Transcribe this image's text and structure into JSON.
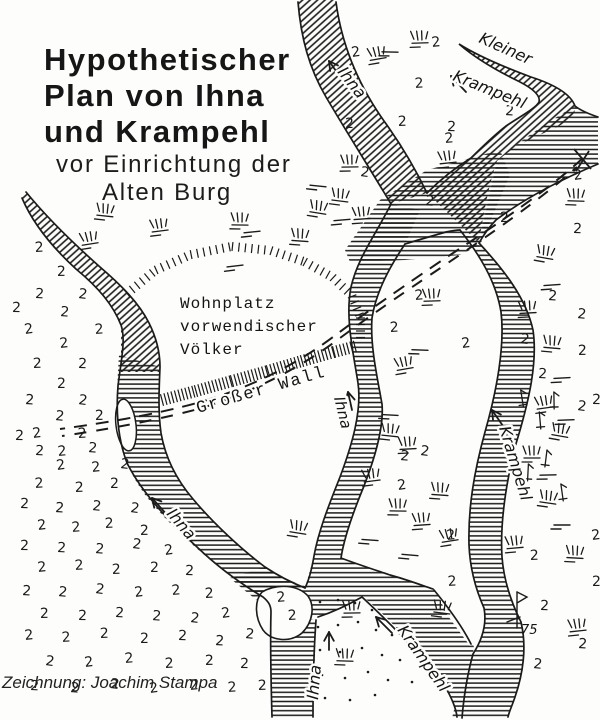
{
  "title": {
    "line1": "Hypothetischer",
    "line2": "Plan von Ihna",
    "line3": "und Krampehl",
    "line4": "vor Einrichtung der",
    "line5": "Alten Burg"
  },
  "credit": "Zeichnung: Joachim Stampa",
  "signature": {
    "year": "75"
  },
  "labels": {
    "ihna_top": "Ihna",
    "kleiner": "Kleiner",
    "krampehl_top": "Krampehl",
    "ihna_mid": "Ihna",
    "krampehl_right": "Krampehl",
    "ihna_sw": "Ihna",
    "ihna_bottom": "Ihna",
    "krampehl_bottom": "Krampehl",
    "wall": "Großer Wall",
    "wohnplatz": [
      "Wohnplatz",
      "vorwendischer",
      "Völker"
    ]
  },
  "colors": {
    "ink": "#1b1b1b",
    "paper": "#fdfdfb"
  },
  "map_symbols": {
    "marsh_glyph": "2",
    "marsh_positions": [
      [
        352,
        57
      ],
      [
        432,
        47
      ],
      [
        415,
        88
      ],
      [
        398,
        126
      ],
      [
        345,
        128
      ],
      [
        447,
        131
      ],
      [
        505,
        115
      ],
      [
        425,
        205
      ],
      [
        360,
        176
      ],
      [
        574,
        180
      ],
      [
        445,
        143
      ],
      [
        35,
        252
      ],
      [
        57,
        276
      ],
      [
        12,
        312
      ],
      [
        35,
        298
      ],
      [
        60,
        316
      ],
      [
        78,
        298
      ],
      [
        25,
        334
      ],
      [
        60,
        348
      ],
      [
        95,
        334
      ],
      [
        33,
        368
      ],
      [
        57,
        388
      ],
      [
        78,
        368
      ],
      [
        25,
        404
      ],
      [
        55,
        420
      ],
      [
        78,
        404
      ],
      [
        33,
        438
      ],
      [
        58,
        456
      ],
      [
        78,
        438
      ],
      [
        95,
        420
      ],
      [
        15,
        440
      ],
      [
        35,
        455
      ],
      [
        88,
        452
      ],
      [
        120,
        468
      ],
      [
        57,
        470
      ],
      [
        92,
        472
      ],
      [
        35,
        488
      ],
      [
        75,
        492
      ],
      [
        110,
        488
      ],
      [
        20,
        508
      ],
      [
        55,
        512
      ],
      [
        92,
        510
      ],
      [
        130,
        512
      ],
      [
        38,
        530
      ],
      [
        72,
        532
      ],
      [
        105,
        528
      ],
      [
        140,
        535
      ],
      [
        20,
        550
      ],
      [
        57,
        552
      ],
      [
        95,
        553
      ],
      [
        132,
        548
      ],
      [
        165,
        555
      ],
      [
        38,
        572
      ],
      [
        75,
        570
      ],
      [
        112,
        574
      ],
      [
        150,
        572
      ],
      [
        185,
        575
      ],
      [
        22,
        595
      ],
      [
        58,
        596
      ],
      [
        95,
        593
      ],
      [
        135,
        597
      ],
      [
        172,
        595
      ],
      [
        205,
        598
      ],
      [
        40,
        618
      ],
      [
        78,
        620
      ],
      [
        115,
        617
      ],
      [
        152,
        620
      ],
      [
        190,
        622
      ],
      [
        222,
        618
      ],
      [
        25,
        640
      ],
      [
        62,
        642
      ],
      [
        100,
        638
      ],
      [
        140,
        643
      ],
      [
        178,
        640
      ],
      [
        215,
        645
      ],
      [
        245,
        638
      ],
      [
        45,
        665
      ],
      [
        85,
        667
      ],
      [
        125,
        663
      ],
      [
        165,
        668
      ],
      [
        205,
        665
      ],
      [
        240,
        668
      ],
      [
        30,
        690
      ],
      [
        70,
        692
      ],
      [
        110,
        688
      ],
      [
        150,
        693
      ],
      [
        190,
        690
      ],
      [
        228,
        692
      ],
      [
        258,
        690
      ],
      [
        500,
        222
      ],
      [
        573,
        233
      ],
      [
        548,
        300
      ],
      [
        577,
        318
      ],
      [
        520,
        343
      ],
      [
        462,
        348
      ],
      [
        415,
        300
      ],
      [
        390,
        332
      ],
      [
        578,
        355
      ],
      [
        592,
        404
      ],
      [
        538,
        378
      ],
      [
        400,
        460
      ],
      [
        420,
        455
      ],
      [
        398,
        490
      ],
      [
        447,
        540
      ],
      [
        448,
        586
      ],
      [
        530,
        560
      ],
      [
        592,
        586
      ],
      [
        540,
        610
      ],
      [
        578,
        648
      ],
      [
        533,
        668
      ],
      [
        577,
        410
      ],
      [
        592,
        540
      ],
      [
        277,
        602
      ],
      [
        288,
        620
      ]
    ],
    "tuft_positions": [
      [
        378,
        58
      ],
      [
        420,
        42
      ],
      [
        105,
        215
      ],
      [
        160,
        230
      ],
      [
        240,
        224
      ],
      [
        318,
        212
      ],
      [
        362,
        218
      ],
      [
        300,
        240
      ],
      [
        90,
        243
      ],
      [
        350,
        166
      ],
      [
        340,
        200
      ],
      [
        448,
        162
      ],
      [
        576,
        200
      ],
      [
        545,
        257
      ],
      [
        528,
        312
      ],
      [
        552,
        347
      ],
      [
        545,
        407
      ],
      [
        532,
        457
      ],
      [
        548,
        502
      ],
      [
        515,
        547
      ],
      [
        575,
        557
      ],
      [
        405,
        368
      ],
      [
        432,
        300
      ],
      [
        390,
        435
      ],
      [
        372,
        480
      ],
      [
        398,
        510
      ],
      [
        298,
        532
      ],
      [
        422,
        524
      ],
      [
        440,
        494
      ],
      [
        450,
        540
      ],
      [
        352,
        612
      ],
      [
        442,
        612
      ],
      [
        578,
        630
      ],
      [
        345,
        660
      ],
      [
        560,
        435
      ],
      [
        408,
        448
      ]
    ],
    "dash_positions": [
      [
        235,
        266
      ],
      [
        252,
        232
      ],
      [
        342,
        220
      ],
      [
        552,
        285
      ],
      [
        562,
        378
      ],
      [
        566,
        420
      ],
      [
        548,
        475
      ],
      [
        562,
        525
      ],
      [
        390,
        52
      ],
      [
        420,
        350
      ],
      [
        390,
        415
      ],
      [
        370,
        540
      ],
      [
        410,
        555
      ],
      [
        318,
        186
      ]
    ],
    "reed_positions": [
      [
        522,
        398
      ],
      [
        540,
        420
      ],
      [
        554,
        400
      ],
      [
        528,
        472
      ],
      [
        546,
        458
      ],
      [
        562,
        492
      ]
    ],
    "dot_positions": [
      [
        320,
        602
      ],
      [
        338,
        600
      ],
      [
        355,
        603
      ],
      [
        372,
        610
      ],
      [
        318,
        627
      ],
      [
        338,
        625
      ],
      [
        358,
        622
      ],
      [
        376,
        630
      ],
      [
        392,
        635
      ],
      [
        320,
        650
      ],
      [
        340,
        652
      ],
      [
        362,
        648
      ],
      [
        382,
        655
      ],
      [
        322,
        675
      ],
      [
        345,
        678
      ],
      [
        368,
        672
      ],
      [
        388,
        680
      ],
      [
        325,
        698
      ],
      [
        350,
        700
      ],
      [
        375,
        695
      ],
      [
        400,
        660
      ],
      [
        412,
        682
      ]
    ]
  }
}
